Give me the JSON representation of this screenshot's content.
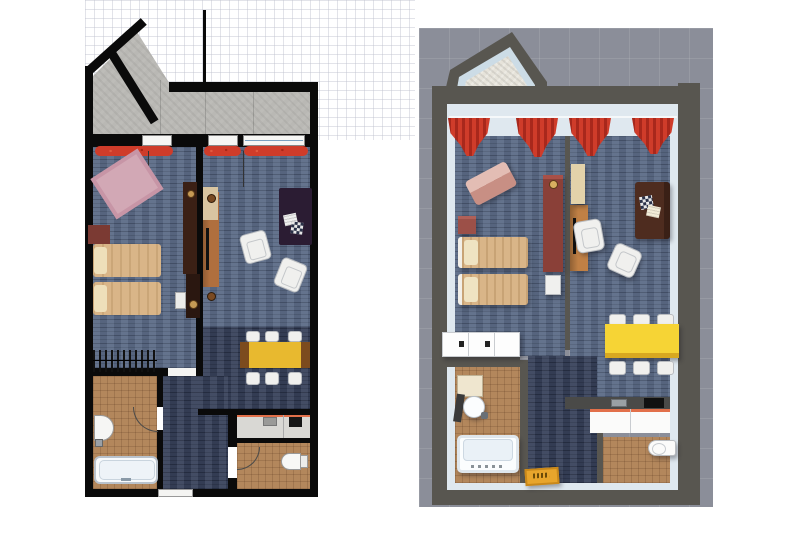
{
  "views": {
    "plan2d": {
      "label": "2D floor plan view"
    },
    "plan3d": {
      "label": "3D floor plan view"
    }
  },
  "rooms": [
    "balcony",
    "bedroom",
    "living-room",
    "dining-area",
    "hallway",
    "bathroom",
    "kitchen",
    "wc"
  ],
  "labels": {
    "balcony": "balcony with concrete floor",
    "curtain": "red curtain",
    "window": "window",
    "rug": "pink rug",
    "dresser": "dark red dresser",
    "bed": "single bed",
    "pillow": "pillow",
    "closet": "closet",
    "wardrobe": "dark wardrobe",
    "tv_cabinet": "TV cabinet",
    "side_cabinet": "side cabinet",
    "nightstand": "nightstand",
    "sofa": "sofa",
    "armchair": "armchair",
    "dining_table": "dining table",
    "chair": "dining chair",
    "kitchen_counter": "kitchen counter",
    "cooktop": "cooktop",
    "kitchen_sink": "kitchen sink",
    "bathtub": "bathtub",
    "bath_sink": "washbasin",
    "bin": "waste bin",
    "toilet": "toilet",
    "entry_door": "entry door",
    "door": "door opening",
    "doormat": "doormat",
    "lounge_chair": "lounge chair",
    "cabinet_row": "white cabinet row"
  },
  "palette": {
    "background": "#ffffff",
    "grid_light": "#bec1ce",
    "wall_2d": "#0a0a0a",
    "carpet_blue": "#5c6c87",
    "carpet_navy": "#39435c",
    "concrete_gray": "#b9b8b4",
    "tile_brown": "#b3875c",
    "curtain_red": "#cf3c2a",
    "bed_tan": "#d9b588",
    "pillow_cream": "#eedfba",
    "rug_pink": "#d2a8b5",
    "dresser_maroon": "#7b3a33",
    "wardrobe_dark": "#3b2015",
    "wood_mid": "#b06f3e",
    "cabinet_tan": "#d9c5a1",
    "sofa_purple": "#2b1c33",
    "sofa_brown": "#4e2c1f",
    "chair_white": "#f0f0ee",
    "table_yellow": "#e8b92f",
    "table_yellow_3d": "#f6d435",
    "counter_gray": "#d9d8d4",
    "counter_accent": "#e2704a",
    "bg_3d": "#8b8e99",
    "wall_3d_dark": "#585650",
    "wall_3d_face": "#dfe8ef",
    "doormat_orange": "#e8a52c"
  }
}
